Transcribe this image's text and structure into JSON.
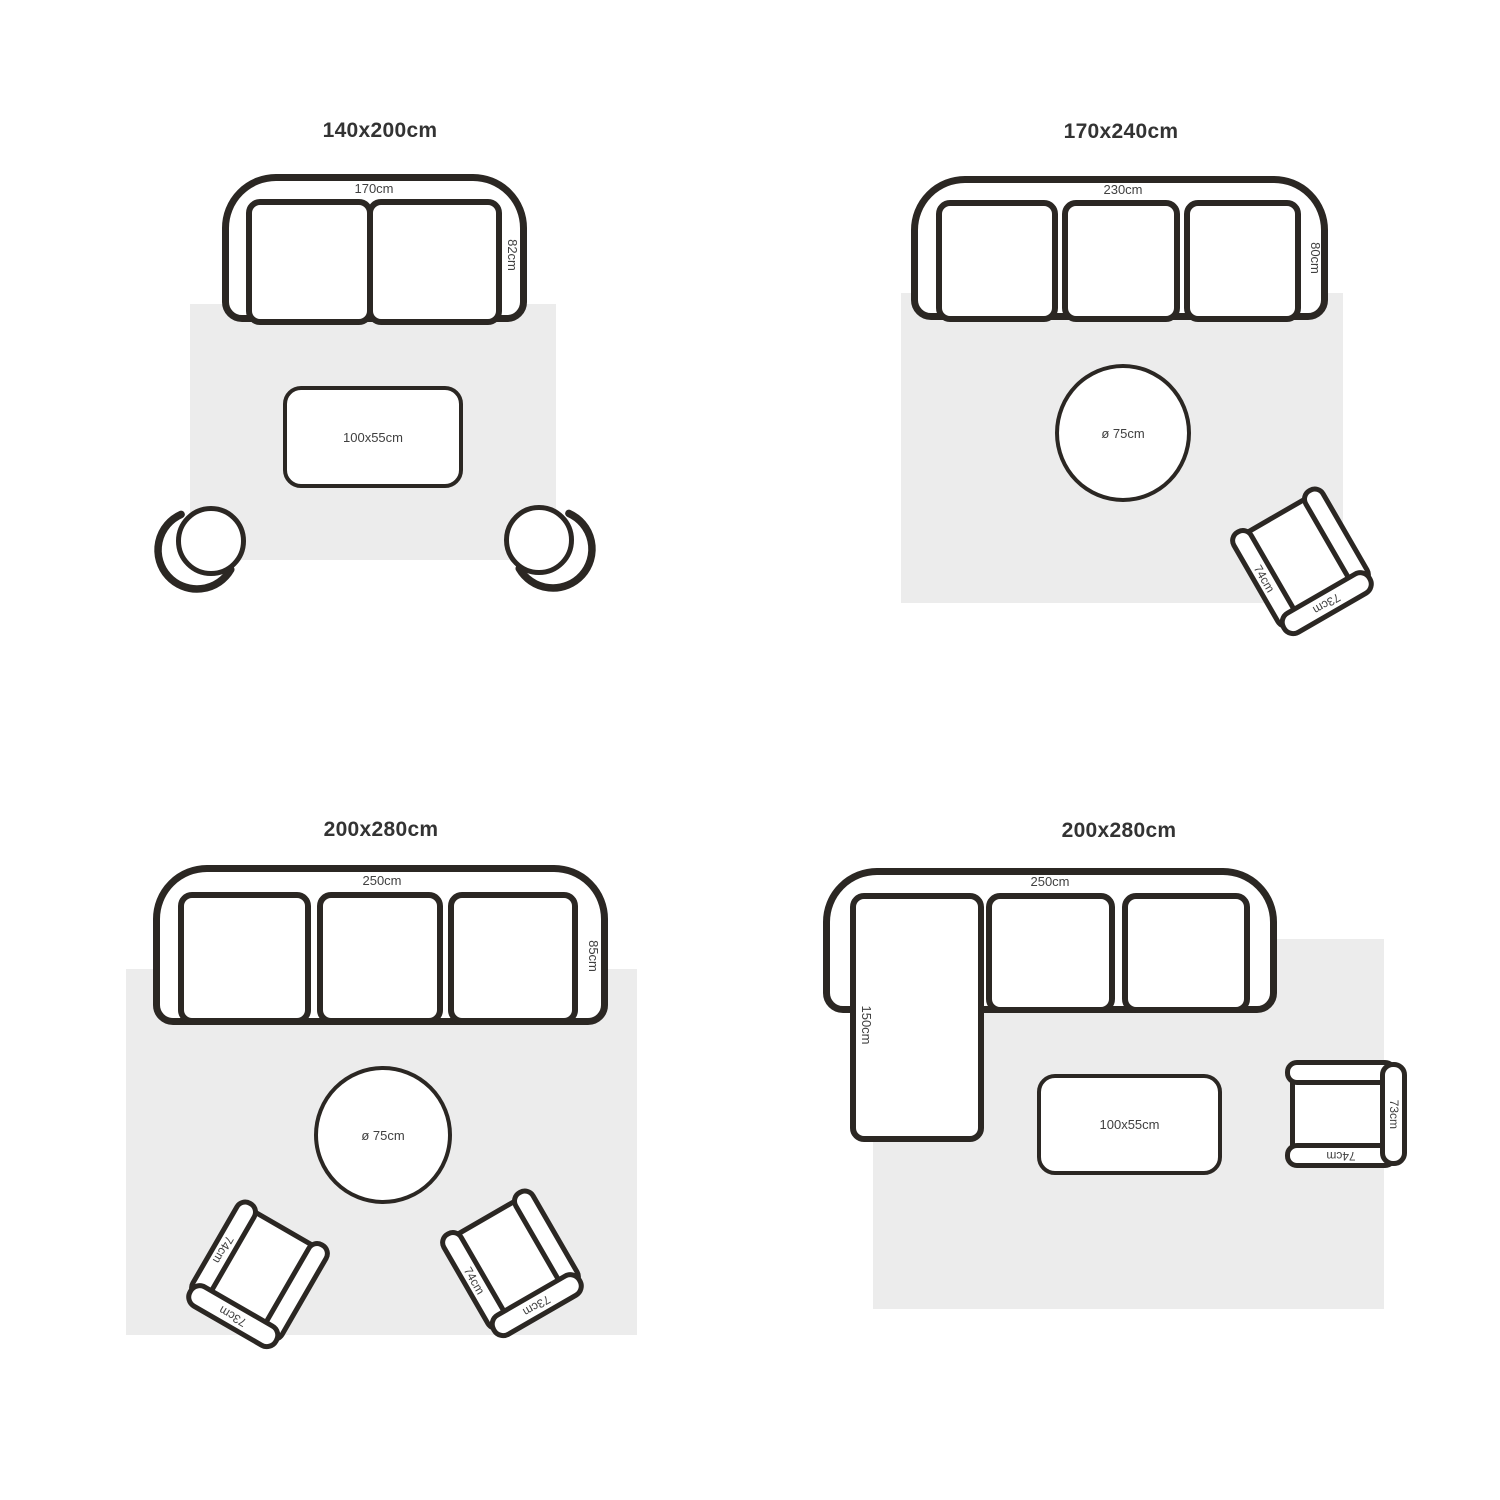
{
  "colors": {
    "background": "#ffffff",
    "outline": "#2b2723",
    "rug_fill": "#ececec",
    "label_text": "#404040",
    "title_text": "#333333"
  },
  "layouts": {
    "q1": {
      "title": "140x200cm",
      "sofa_width": "170cm",
      "sofa_depth": "82cm",
      "table": "100x55cm"
    },
    "q2": {
      "title": "170x240cm",
      "sofa_width": "230cm",
      "sofa_depth": "80cm",
      "table": "ø 75cm",
      "chair": {
        "arm": "74cm",
        "back": "73cm"
      }
    },
    "q3": {
      "title": "200x280cm",
      "sofa_width": "250cm",
      "sofa_depth": "85cm",
      "table": "ø 75cm",
      "chair_left": {
        "arm": "74cm",
        "back": "73cm"
      },
      "chair_right": {
        "arm": "74cm",
        "back": "73cm"
      }
    },
    "q4": {
      "title": "200x280cm",
      "sofa_width": "250cm",
      "chaise_depth": "150cm",
      "table": "100x55cm",
      "chair": {
        "arm": "74cm",
        "back": "73cm"
      }
    }
  }
}
